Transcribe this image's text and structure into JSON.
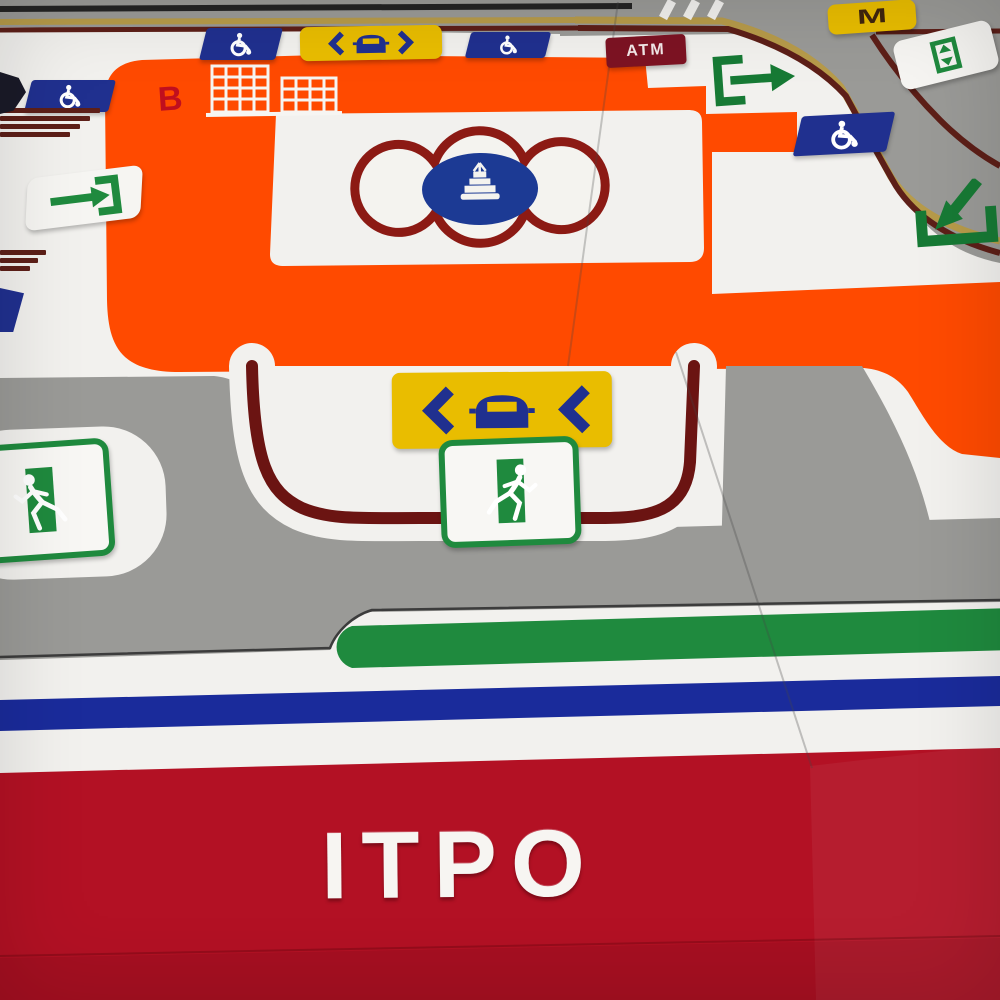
{
  "board": {
    "type": "tactile station map photo",
    "station_label": "ITPO",
    "block_label": "B",
    "atm_label": "ATM",
    "metro_label": "M"
  },
  "colors": {
    "concourse_orange": "#ff4a00",
    "board_white": "#f2f1ee",
    "road_gray": "#9a9a97",
    "curb_maroon": "#5d1f18",
    "lane_yellow": "#b79b4a",
    "sign_blue": "#20308f",
    "sign_yellow": "#e9bd00",
    "exit_green": "#1f8a3e",
    "line_stripe_blue": "#1a2b9b",
    "station_band_crimson": "#b31124",
    "atm_red": "#7d1323",
    "landmark_medallion_blue": "#1c3a94"
  },
  "icons": [
    {
      "name": "wheelchair-icon",
      "meaning": "accessible facility",
      "count": 4
    },
    {
      "name": "car-both-ways-icon",
      "meaning": "car lane both directions"
    },
    {
      "name": "car-left-icon",
      "meaning": "pick-up / drop-off lane to left"
    },
    {
      "name": "metro-logo-icon",
      "meaning": "metro station marker"
    },
    {
      "name": "lift-icon",
      "meaning": "lift"
    },
    {
      "name": "exit-gate-icon",
      "meaning": "gate, arrow out"
    },
    {
      "name": "entry-gate-icon",
      "meaning": "gate, arrow in"
    },
    {
      "name": "lift-down-icon",
      "meaning": "arrow down into lift/subway"
    },
    {
      "name": "emergency-exit-icon",
      "meaning": "running man exit",
      "count": 2
    },
    {
      "name": "fountain-icon",
      "meaning": "landmark medallion in quatrefoil"
    },
    {
      "name": "buildings-icon",
      "meaning": "building block outline"
    },
    {
      "name": "stairs-icon",
      "meaning": "staircase bars",
      "count": 2
    }
  ]
}
